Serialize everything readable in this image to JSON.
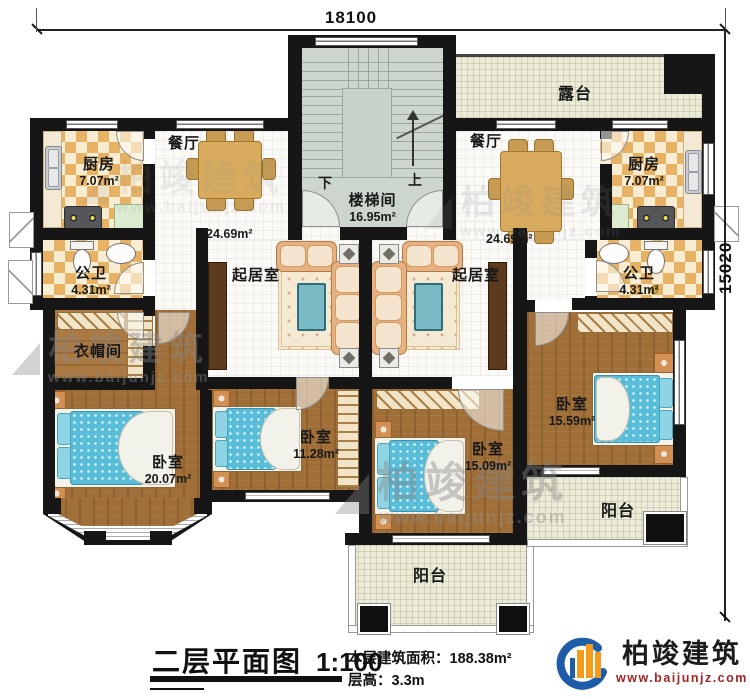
{
  "plan": {
    "dimensions": {
      "width": "18100",
      "height": "15020"
    },
    "stair": {
      "down": "下",
      "up": "上"
    },
    "rooms": {
      "terrace": {
        "label": "露台"
      },
      "stairwell": {
        "label": "楼梯间",
        "area": "16.95m²"
      },
      "dining_left": {
        "label": "餐厅",
        "area": "24.69m²"
      },
      "dining_right": {
        "label": "餐厅",
        "area": "24.69m²"
      },
      "kitchen_left": {
        "label": "厨房",
        "area": "7.07m²"
      },
      "kitchen_right": {
        "label": "厨房",
        "area": "7.07m²"
      },
      "bath_left": {
        "label": "公卫",
        "area": "4.31m²"
      },
      "bath_right": {
        "label": "公卫",
        "area": "4.31m²"
      },
      "cloakroom": {
        "label": "衣帽间"
      },
      "living_left": {
        "label": "起居室"
      },
      "living_right": {
        "label": "起居室"
      },
      "bedroom_sw": {
        "label": "卧室",
        "area": "20.07m²"
      },
      "bedroom_s": {
        "label": "卧室",
        "area": "11.28m²"
      },
      "bedroom_se": {
        "label": "卧室",
        "area": "15.09m²"
      },
      "bedroom_e": {
        "label": "卧室",
        "area": "15.59m²"
      },
      "balcony_mid": {
        "label": "阳台"
      },
      "balcony_right": {
        "label": "阳台"
      }
    }
  },
  "titleblock": {
    "title": "二层平面图",
    "scale": "1:100",
    "area_label": "本层建筑面积：",
    "area_value": "188.38m²",
    "height_label": "层高：",
    "height_value": "3.3m"
  },
  "branding": {
    "name": "柏竣建筑",
    "url": "www.baijunjz.com"
  },
  "watermark": {
    "name": "柏竣建筑",
    "url": "www.baijunjz.com"
  }
}
